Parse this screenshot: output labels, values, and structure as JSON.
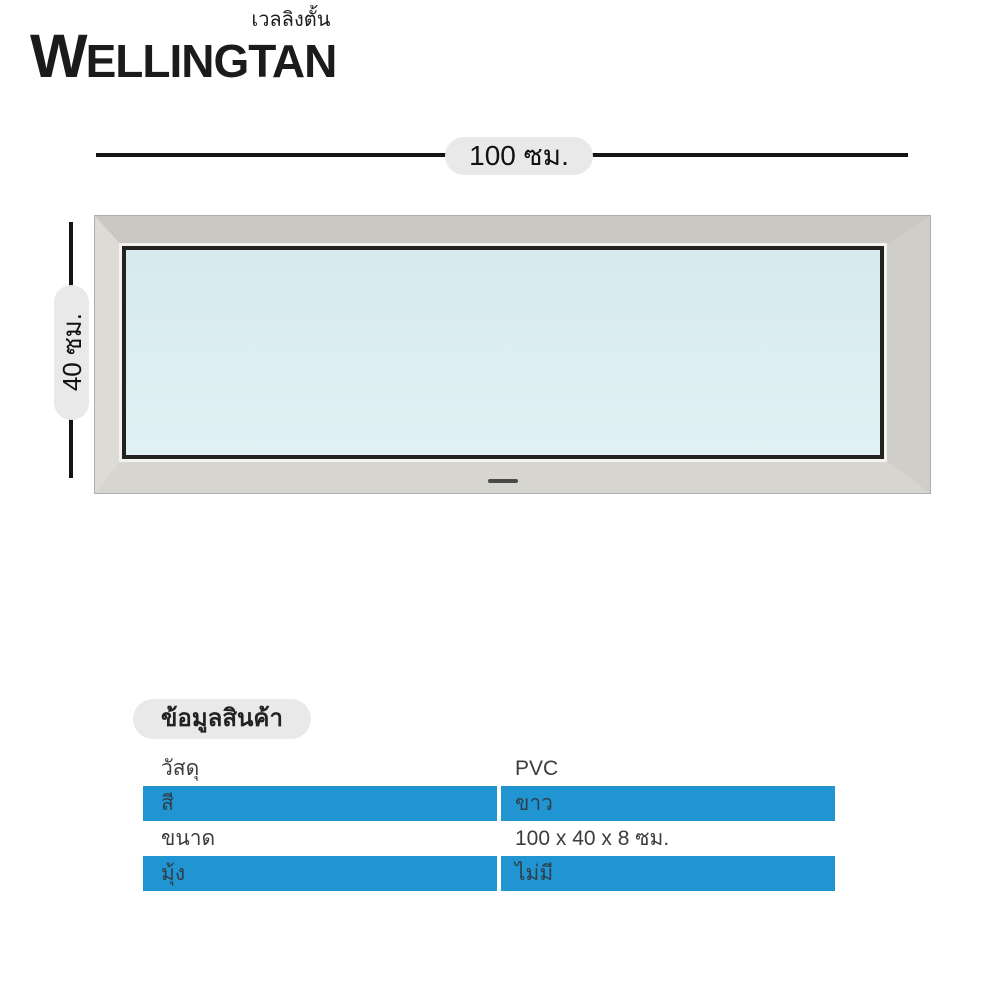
{
  "brand": {
    "thai_name": "เวลลิงตั้น",
    "name_initial": "W",
    "name_rest": "ELLINGTAN"
  },
  "dimension_diagram": {
    "width_label": "100 ซม.",
    "height_label": "40 ซม."
  },
  "product_info": {
    "title": "ข้อมูลสินค้า",
    "rows": [
      {
        "label": "วัสดุ",
        "value": "PVC",
        "highlight": false
      },
      {
        "label": "สี",
        "value": "ขาว",
        "highlight": true
      },
      {
        "label": "ขนาด",
        "value": "100 x 40 x 8 ซม.",
        "highlight": false
      },
      {
        "label": "มุ้ง",
        "value": "ไม่มี",
        "highlight": true
      }
    ]
  },
  "colors": {
    "accent_blue": "#2095d2",
    "row_text_dark": "#3c3c3c",
    "row_text_on_blue": "#2f3f4a",
    "frame_silver": "#d2d1cc",
    "glass_blue": "#dceef2",
    "pill_gray": "#e9e9e9",
    "line_black": "#141414"
  }
}
